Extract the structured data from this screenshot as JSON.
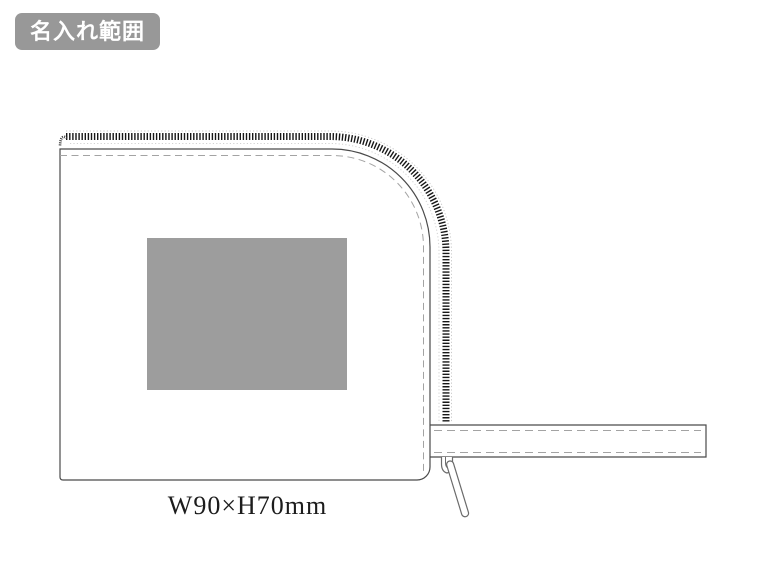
{
  "badge": {
    "label": "名入れ範囲",
    "bg_color": "#989898",
    "text_color": "#ffffff"
  },
  "diagram": {
    "dimension_label": "W90×H70mm",
    "imprint_area": {
      "fill_color": "#9d9d9d"
    },
    "line_colors": {
      "outline": "#4a4a4a",
      "stitch_dashed": "#a3a3a3",
      "zipper_teeth": "#161616",
      "zipper_tape_dotted": "#c9c9c9",
      "pull_outline": "#6b6b6b"
    }
  }
}
